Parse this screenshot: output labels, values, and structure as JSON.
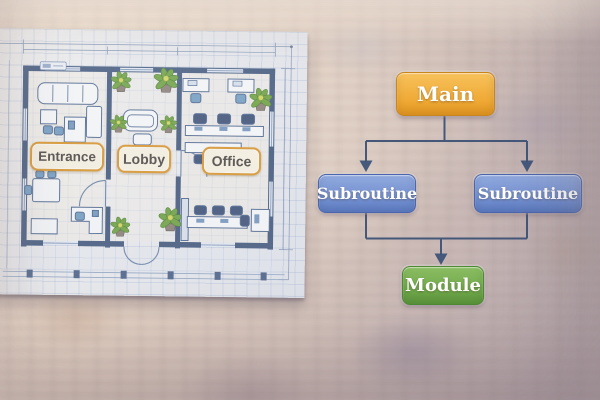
{
  "floor_plan": {
    "room_labels": [
      {
        "text": "Entrance"
      },
      {
        "text": "Lobby"
      },
      {
        "text": "Office"
      }
    ],
    "colors": {
      "label_border": "#e09b31",
      "label_background": "#fcf5e3",
      "label_text": "#57504a",
      "wall_ink": "#4c6081",
      "paper": "#f1f0ef",
      "plant_green": "#76a746",
      "chair_blue": "#7ba3c4"
    }
  },
  "flowchart": {
    "nodes": [
      {
        "id": "main",
        "label": "Main",
        "fill_top": "#f7c25c",
        "fill_bottom": "#eb9c22",
        "border": "#c9861e"
      },
      {
        "id": "subroutine-left",
        "label": "Subroutine",
        "fill_top": "#91a9dd",
        "fill_bottom": "#6181ca",
        "border": "#4b66ae"
      },
      {
        "id": "subroutine-right",
        "label": "Subroutine",
        "fill_top": "#91a9dd",
        "fill_bottom": "#6181ca",
        "border": "#4b66ae"
      },
      {
        "id": "module",
        "label": "Module",
        "fill_top": "#8cbd63",
        "fill_bottom": "#609d3e",
        "border": "#4d8a33"
      }
    ],
    "edges": [
      {
        "from": "main",
        "to": "subroutine-left"
      },
      {
        "from": "main",
        "to": "subroutine-right"
      },
      {
        "from": "subroutine-left",
        "to": "module"
      },
      {
        "from": "subroutine-right",
        "to": "module"
      }
    ],
    "connector_color": "#3e5377"
  }
}
